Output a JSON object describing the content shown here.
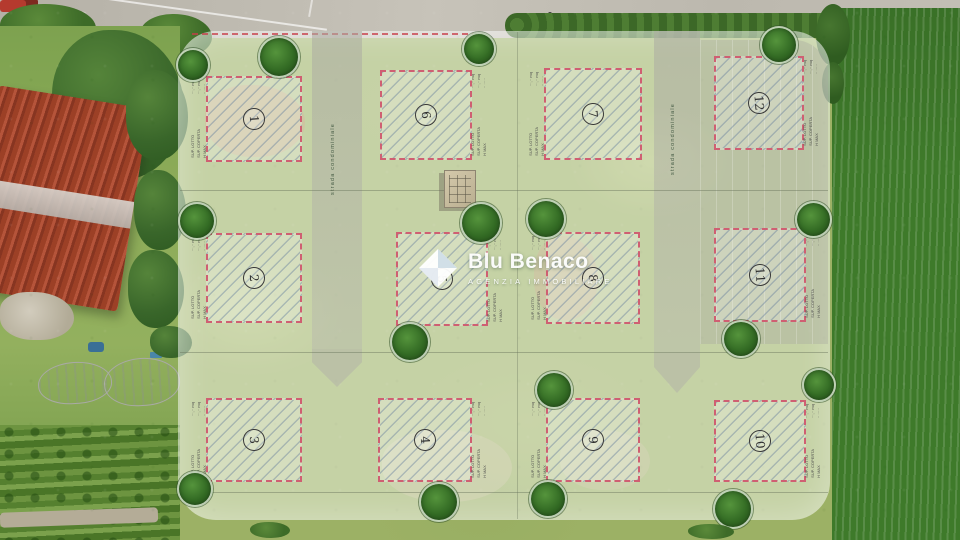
{
  "watermark": {
    "title": "Blu Benaco",
    "subtitle": "AGENZIA IMMOBILIARE"
  },
  "road_label": "strada condominiale",
  "plot_info": {
    "values": "···,·· mq\n···,·· mq\n·· ·····",
    "labels": "SUP. LOTTO\nSUP. COPERTA\nH MAX"
  },
  "plots": [
    {
      "number": "1"
    },
    {
      "number": "2"
    },
    {
      "number": "3"
    },
    {
      "number": "4"
    },
    {
      "number": "5"
    },
    {
      "number": "6"
    },
    {
      "number": "7"
    },
    {
      "number": "8"
    },
    {
      "number": "9"
    },
    {
      "number": "10"
    },
    {
      "number": "11"
    },
    {
      "number": "12"
    }
  ],
  "colors": {
    "plot_border": "#cf5f72",
    "tree_green": "#336b24",
    "crop_field_green": "#3e7a2a",
    "overlay_white": "rgba(255,255,255,0.42)",
    "asphalt": "#bcb8ae"
  }
}
